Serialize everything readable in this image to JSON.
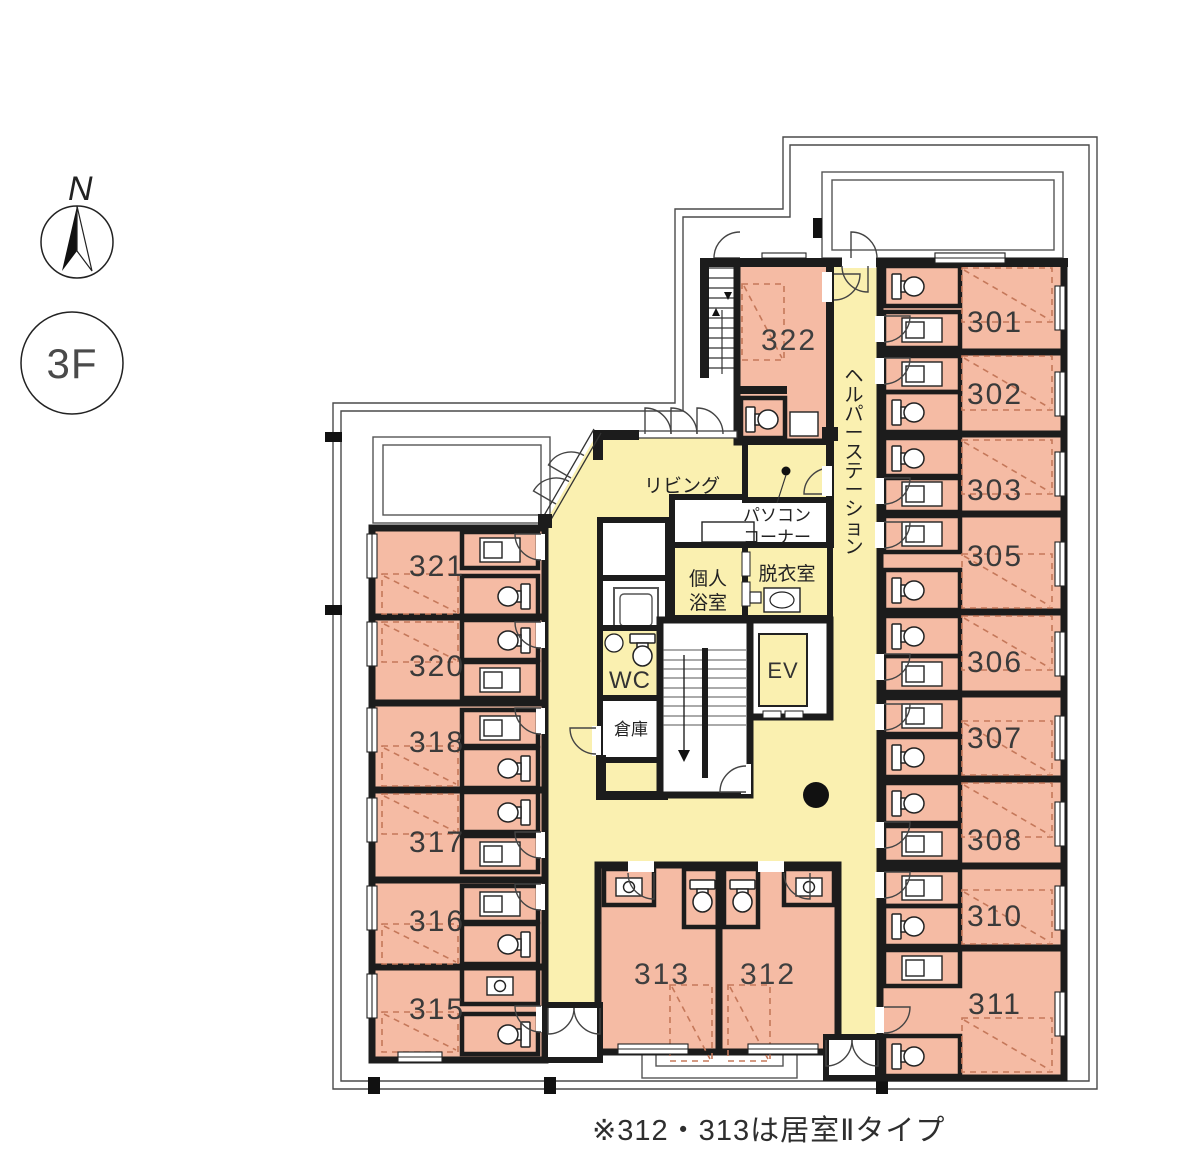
{
  "legend": {
    "north_label": "N",
    "floor_label": "3F"
  },
  "note": "※312・313は居室Ⅱタイプ",
  "areas": {
    "living": "リビング",
    "pc_corner_l1": "パソコン",
    "pc_corner_l2": "コーナー",
    "private_bath_l1": "個人",
    "private_bath_l2": "浴室",
    "dressing": "脱衣室",
    "wc": "WC",
    "storage": "倉庫",
    "elevator": "EV",
    "helper_station": "ヘルパーステーション"
  },
  "rooms": {
    "r301": "301",
    "r302": "302",
    "r303": "303",
    "r305": "305",
    "r306": "306",
    "r307": "307",
    "r308": "308",
    "r310": "310",
    "r311": "311",
    "r312": "312",
    "r313": "313",
    "r315": "315",
    "r316": "316",
    "r317": "317",
    "r318": "318",
    "r320": "320",
    "r321": "321",
    "r322": "322"
  },
  "colors": {
    "room_fill": "#f5bba4",
    "common_fill": "#faf0b0",
    "wall": "#1c1c1c",
    "bed_line": "#c5785a"
  }
}
